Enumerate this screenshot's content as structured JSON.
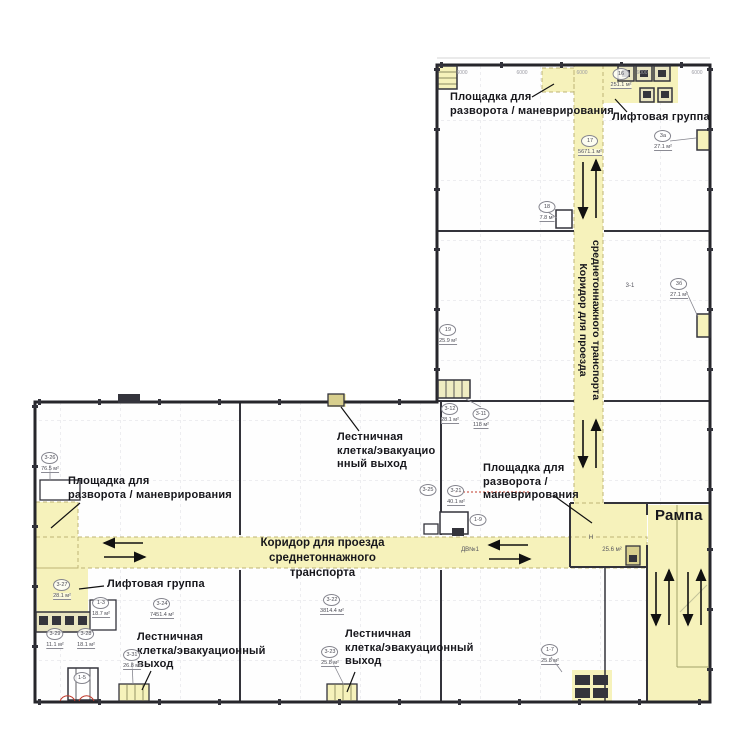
{
  "title": "Складской этаж — план с транспортными коридорами",
  "colors": {
    "zone_yellow": "#f5f1b7",
    "zone_border": "#bdb476",
    "wall": "#2b2b33",
    "grid": "#dcdce2",
    "label": "#17171c",
    "tag": "#4c4c55",
    "accent_red": "#c0392b"
  },
  "labels": {
    "area_top": "Площадка для\nразворота / маневрирования",
    "lift_top": "Лифтовая группа",
    "stair_mid": "Лестничная\nклетка/эвакуацио\nнный выход",
    "area_left": "Площадка для\nразворота / маневрирования",
    "area_right": "Площадка для\nразворота /\nманеврирования",
    "ramp": "Рампа",
    "lift_bottom": "Лифтовая группа",
    "stair_bottom_left": "Лестничная\nклетка/эвакуационный\nвыход",
    "stair_bottom_mid": "Лестничная\nклетка/эвакуационный\nвыход",
    "corridor": {
      "line1": "Коридор для проезда",
      "line2": "среднетоннажного транспорта"
    }
  },
  "rooms": [
    {
      "id": "17",
      "area": "5671.1 м²",
      "x": 590,
      "y": 141
    },
    {
      "id": "16",
      "area": "251.1 м²",
      "x": 621,
      "y": 74
    },
    {
      "id": "3а",
      "area": "27.1 м²",
      "x": 663,
      "y": 136
    },
    {
      "id": "18",
      "area": "7.8 м²",
      "x": 547,
      "y": 207
    },
    {
      "id": "3б",
      "area": "27.1 м²",
      "x": 679,
      "y": 284
    },
    {
      "id": "19",
      "area": "25.9 м²",
      "x": 448,
      "y": 330
    },
    {
      "id": "3-12",
      "area": "28.1 м²",
      "x": 450,
      "y": 409
    },
    {
      "id": "3-11",
      "area": "118 м²",
      "x": 481,
      "y": 414
    },
    {
      "id": "3-26",
      "area": "76.5 м²",
      "x": 50,
      "y": 458
    },
    {
      "id": "3-25",
      "area": "",
      "x": 428,
      "y": 490
    },
    {
      "id": "3-21",
      "area": "40.1 м²",
      "x": 456,
      "y": 491
    },
    {
      "id": "1-9",
      "area": "",
      "x": 478,
      "y": 520
    },
    {
      "id": "3-27",
      "area": "28.1 м²",
      "x": 62,
      "y": 585
    },
    {
      "id": "1-3",
      "area": "18.7 м²",
      "x": 101,
      "y": 603
    },
    {
      "id": "3-29",
      "area": "11.1 м²",
      "x": 55,
      "y": 634
    },
    {
      "id": "3-28",
      "area": "18.1 м²",
      "x": 86,
      "y": 634
    },
    {
      "id": "1-5",
      "area": "",
      "x": 82,
      "y": 678
    },
    {
      "id": "3-31",
      "area": "26.8 м²",
      "x": 132,
      "y": 655
    },
    {
      "id": "3-24",
      "area": "7451.4 м²",
      "x": 162,
      "y": 604
    },
    {
      "id": "3-22",
      "area": "3814.4 м²",
      "x": 332,
      "y": 600
    },
    {
      "id": "3-23",
      "area": "25.8 м²",
      "x": 330,
      "y": 652
    },
    {
      "id": "1-7",
      "area": "25.8 м²",
      "x": 550,
      "y": 650
    }
  ],
  "small_texts": [
    {
      "t": "ДВ№1",
      "x": 470,
      "y": 550
    },
    {
      "t": "Н",
      "x": 591,
      "y": 538
    },
    {
      "t": "25.6 м²",
      "x": 612,
      "y": 550
    },
    {
      "t": "3-1",
      "x": 630,
      "y": 286
    }
  ],
  "dimensions": {
    "value": "6000",
    "y": 70,
    "xs": [
      462,
      522,
      582,
      642,
      697
    ]
  }
}
